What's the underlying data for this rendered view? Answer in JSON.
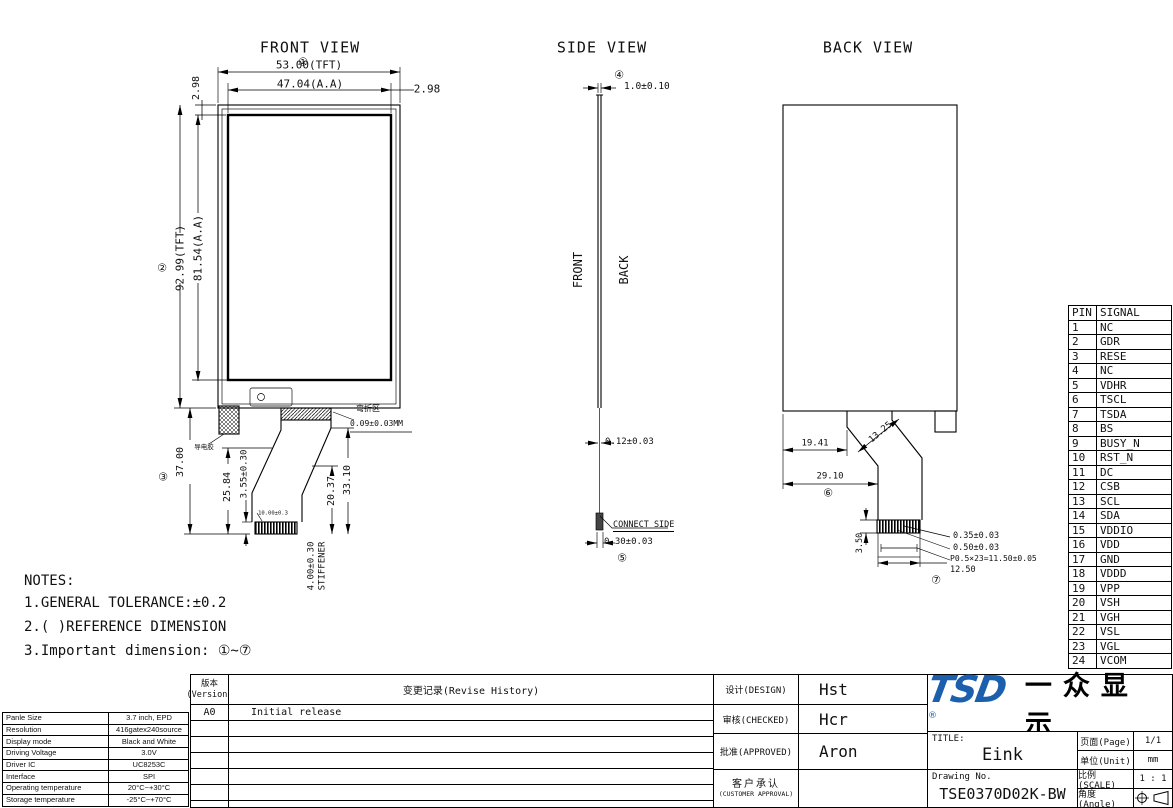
{
  "fv": {
    "title": "FRONT VIEW",
    "m1": "①",
    "w_tft": "53.00(TFT)",
    "w_aa": "47.04(A.A)",
    "r298": "2.98",
    "l298": "2.98",
    "m2": "②",
    "h_tft": "92.99(TFT)",
    "h_aa": "81.54(A.A)",
    "m3": "③",
    "d37": "37.00",
    "d2584": "25.84",
    "d355": "3.55±0.30",
    "d2037": "20.37",
    "d3310": "33.10",
    "stiff1": "4.00±0.30",
    "stiff2": "STIFFENER",
    "bend1": "弯折区",
    "bend2": "0.09±0.03MM",
    "foam": "导电胶",
    "fingers": "10.00±0.3"
  },
  "sv": {
    "title": "SIDE VIEW",
    "m4": "④",
    "thk": "1.0±0.10",
    "front": "FRONT",
    "back": "BACK",
    "fpc": "0.12±0.03",
    "connect": "CONNECT SIDE",
    "d030": "0.30±0.03",
    "m5": "⑤"
  },
  "bv": {
    "title": "BACK VIEW",
    "d1941": "19.41",
    "d1325": "13.25",
    "d2910": "29.10",
    "m6": "⑥",
    "d350": "3.50",
    "d035": "0.35±0.03",
    "d050": "0.50±0.03",
    "pitch": "P0.5×23=11.50±0.05",
    "d1250": "12.50",
    "m7": "⑦"
  },
  "pins": {
    "h": [
      "PIN",
      "SIGNAL"
    ],
    "rows": [
      [
        "1",
        "NC"
      ],
      [
        "2",
        "GDR"
      ],
      [
        "3",
        "RESE"
      ],
      [
        "4",
        "NC"
      ],
      [
        "5",
        "VDHR"
      ],
      [
        "6",
        "TSCL"
      ],
      [
        "7",
        "TSDA"
      ],
      [
        "8",
        "BS"
      ],
      [
        "9",
        "BUSY_N"
      ],
      [
        "10",
        "RST_N"
      ],
      [
        "11",
        "DC"
      ],
      [
        "12",
        "CSB"
      ],
      [
        "13",
        "SCL"
      ],
      [
        "14",
        "SDA"
      ],
      [
        "15",
        "VDDIO"
      ],
      [
        "16",
        "VDD"
      ],
      [
        "17",
        "GND"
      ],
      [
        "18",
        "VDDD"
      ],
      [
        "19",
        "VPP"
      ],
      [
        "20",
        "VSH"
      ],
      [
        "21",
        "VGH"
      ],
      [
        "22",
        "VSL"
      ],
      [
        "23",
        "VGL"
      ],
      [
        "24",
        "VCOM"
      ]
    ]
  },
  "notes": {
    "title": "NOTES:",
    "l1": "1.GENERAL TOLERANCE:±0.2",
    "l2": "2.( )REFERENCE DIMENSION",
    "l3": "3.Important dimension: ①~⑦"
  },
  "spec": {
    "rows": [
      [
        "Panle Size",
        "3.7 inch, EPD"
      ],
      [
        "Resolution",
        "416gatex240source"
      ],
      [
        "Display mode",
        "Black and White"
      ],
      [
        "Driving Voltage",
        "3.0V"
      ],
      [
        "Driver IC",
        "UC8253C"
      ],
      [
        "Interface",
        "SPI"
      ],
      [
        "Operating temperature",
        "20°C~+30°C"
      ],
      [
        "Storage temperature",
        "-25°C~+70°C"
      ]
    ]
  },
  "tb": {
    "version_cn": "版本",
    "version_en": "(Version)",
    "history": "变更记录(Revise History)",
    "rev": "A0",
    "rev_desc": "Initial release",
    "design": "设计(DESIGN)",
    "design_v": "Hst",
    "checked": "审核(CHECKED)",
    "checked_v": "Hcr",
    "approved": "批准(APPROVED)",
    "approved_v": "Aron",
    "customer_cn": "客户承认",
    "customer_en": "(CUSTOMER APPROVAL)",
    "logo": "TSD",
    "reg": "®",
    "logo_cn": "一众显示",
    "brand_blue": "#1b5fad",
    "title_label": "TITLE:",
    "title_v": "Eink",
    "drawing_label": "Drawing No.",
    "drawing_v": "TSE0370D02K-BW",
    "page": "页面(Page)",
    "page_v": "1/1",
    "unit": "单位(Unit)",
    "unit_v": "mm",
    "scale": "比例(SCALE)",
    "scale_v": "1 : 1",
    "angle": "角度(Angle)"
  }
}
